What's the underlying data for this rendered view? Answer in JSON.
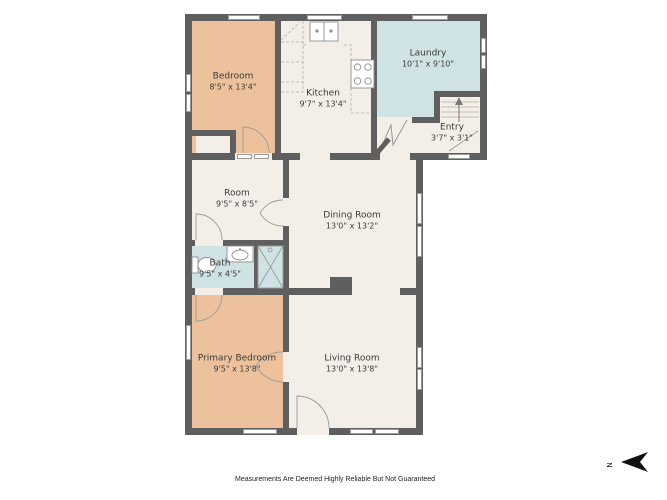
{
  "floorplan": {
    "rooms": [
      {
        "name": "Bedroom",
        "dims": "8'5\" x 13'4\""
      },
      {
        "name": "Kitchen",
        "dims": "9'7\" x 13'4\""
      },
      {
        "name": "Laundry",
        "dims": "10'1\" x 9'10\""
      },
      {
        "name": "Entry",
        "dims": "3'7\" x 3'1\""
      },
      {
        "name": "Room",
        "dims": "9'5\" x 8'5\""
      },
      {
        "name": "Dining Room",
        "dims": "13'0\" x 13'2\""
      },
      {
        "name": "Bath",
        "dims": "9'5\" x 4'5\""
      },
      {
        "name": "Primary Bedroom",
        "dims": "9'5\" x 13'8\""
      },
      {
        "name": "Living Room",
        "dims": "13'0\" x 13'8\""
      }
    ],
    "disclaimer": "Measurements Are Deemed Highly Reliable But Not Guaranteed",
    "compass": {
      "label": "N",
      "direction": "left"
    },
    "colors": {
      "wall": "#5f5f5f",
      "bedroom_fill": "#ecc19b",
      "generic_fill": "#f4eee8",
      "wet_room_fill": "#cfe2e4",
      "background": "#ffffff"
    }
  }
}
